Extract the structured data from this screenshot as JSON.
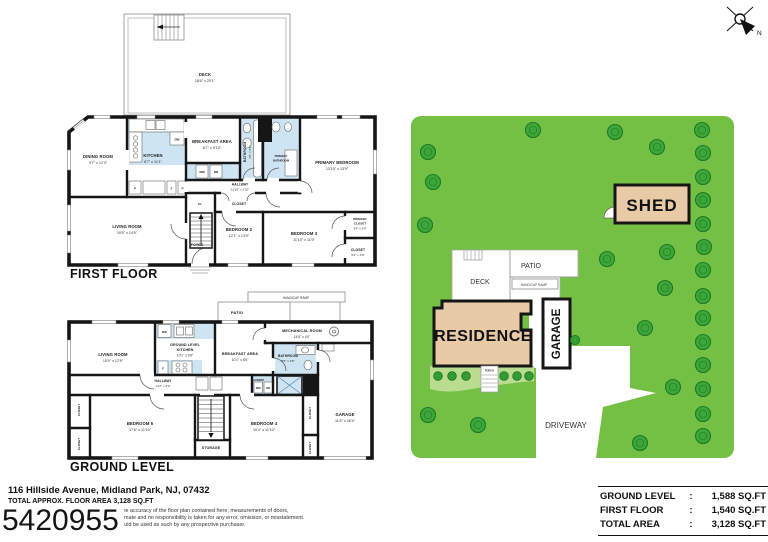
{
  "document": {
    "plan_number": "5420955",
    "address": "116 Hillside Avenue, Midland Park, NJ, 07432",
    "total_area_line": "TOTAL APPROX. FLOOR AREA 3,128 SQ.FT",
    "disclaimer_line1": "Whilst every attempt has been made to ensure the accuracy of the floor plan contained here, measurements of doors,",
    "disclaimer_line2": "windows, rooms and any other items are approximate and no responsibility is taken for any error, omission, or misstatement.",
    "disclaimer_line3": "This plan is for illustrative purposes only and should be used as such by any prospective purchaser."
  },
  "area_table": {
    "rows": [
      {
        "label": "GROUND LEVEL",
        "colon": ":",
        "value": "1,588 SQ.FT"
      },
      {
        "label": "FIRST FLOOR",
        "colon": ":",
        "value": "1,540 SQ.FT"
      },
      {
        "label": "TOTAL AREA",
        "colon": ":",
        "value": "3,128 SQ.FT"
      }
    ]
  },
  "labels": {
    "closet": "CLOSET",
    "cl": "CL",
    "foyer": "FOYER",
    "storage": "STORAGE",
    "laundry": "LAUNDRY",
    "dw": "DW",
    "wm": "WM",
    "ww": "WW",
    "dr": "DR",
    "p": "P",
    "f": "F"
  },
  "first_floor": {
    "title": "FIRST FLOOR",
    "deck": {
      "name": "DECK",
      "dims": "18'6\" x 20'1\""
    },
    "dining_room": {
      "name": "DINING ROOM",
      "dims": "9'7\" x 12'3\""
    },
    "kitchen": {
      "name": "KITCHEN",
      "dims": "8'7\" x 11'1\""
    },
    "breakfast_area": {
      "name": "BREAKFAST AREA",
      "dims": "8'7\" x 9'10\""
    },
    "bathroom": {
      "name": "BATHROOM",
      "dims": "4'5\" x 8'1\""
    },
    "primary_bathroom": {
      "word1": "PRIMARY",
      "word2": "BATHROOM"
    },
    "primary_bedroom": {
      "name": "PRIMARY BEDROOM",
      "dims": "13'10\" x 13'9\""
    },
    "hallway": {
      "name": "HALLWAY",
      "dims": "21'10\" x 2'10\""
    },
    "living_room": {
      "name": "LIVING ROOM",
      "dims": "19'5\" x 14'9\""
    },
    "bedroom2": {
      "name": "BEDROOM 2",
      "dims": "12'1\" x 13'0\""
    },
    "bedroom3": {
      "name": "BEDROOM 3",
      "dims": "11'10\" x 11'9\""
    },
    "primary_closet": {
      "word1": "PRIMARY",
      "word2": "CLOSET",
      "dims": "3'4\" x 5'0\""
    },
    "closet_br": {
      "name": "CLOSET",
      "dims": "5'4\" x 3'8\""
    }
  },
  "ground_level": {
    "title": "GROUND LEVEL",
    "patio": "PATIO",
    "handicap_ramp": "HANDICAP RAMP",
    "living_room": {
      "name": "LIVING ROOM",
      "dims": "15'9\" x 12'9\""
    },
    "kitchen": {
      "line1": "GROUND LEVEL",
      "line2": "KITCHEN",
      "dims": "10'1\" x 9'8\""
    },
    "breakfast_area": {
      "name": "BREAKFAST AREA",
      "dims": "10'1\" x 8'6\""
    },
    "mechanical_room": {
      "name": "MECHANICAL ROOM",
      "dims": "14'8\" x 4'0\""
    },
    "bathroom": {
      "name": "BATHROOM",
      "dims": "8'5\" x 9'8\""
    },
    "hallway": {
      "name": "HALLWAY",
      "dims": "14'7\" x 3'3\""
    },
    "bedroom5": {
      "name": "BEDROOM 5",
      "dims": "17'6\" x 11'10\""
    },
    "bedroom4": {
      "name": "BEDROOM 4",
      "dims": "10'4\" x 11'10\""
    },
    "garage": {
      "name": "GARAGE",
      "dims": "11'8\" x 26'4\""
    }
  },
  "site_plan": {
    "shed": "SHED",
    "residence": "RESIDENCE",
    "garage": "GARAGE",
    "deck": "DECK",
    "patio": "PATIO",
    "handicap_ramp": "HANDICAP RAMP",
    "porch": "PORCH",
    "driveway": "DRIVEWAY",
    "north": "N",
    "colors": {
      "lawn": "#74c044",
      "light_lawn": "#b9dc8e",
      "tree": "#3da639",
      "tree_dark": "#1d7a24",
      "building": "#e9caa7",
      "wall": "#161616",
      "wet_room": "#cfe4f3"
    }
  }
}
